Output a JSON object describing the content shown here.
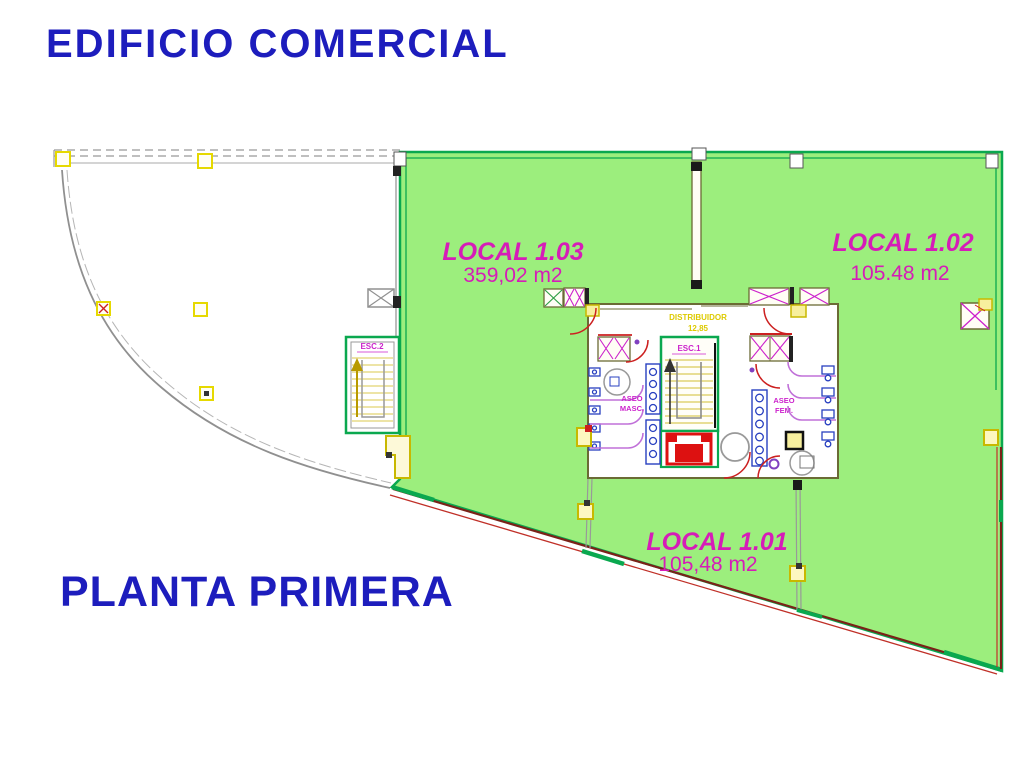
{
  "titles": {
    "building": "EDIFICIO COMERCIAL",
    "floor": "PLANTA PRIMERA"
  },
  "units": [
    {
      "name": "LOCAL 1.03",
      "area": "359,02 m2"
    },
    {
      "name": "LOCAL 1.02",
      "area": "105.48 m2"
    },
    {
      "name": "LOCAL 1.01",
      "area": "105,48 m2"
    }
  ],
  "core": {
    "stair1": "ESC.1",
    "stair2": "ESC.2",
    "men_restroom": [
      "ASEO",
      "MASC."
    ],
    "women_restroom": [
      "ASEO",
      "FEM."
    ],
    "corridor": [
      "DISTRIBUIDOR",
      "12,85"
    ]
  },
  "colors": {
    "title_blue": "#1d1dbd",
    "label_magenta": "#d61cb8",
    "floor_fill_green": "#9cee7d",
    "border_green": "#0aa84f",
    "facade_red": "#c03028",
    "cad_yellow": "#e6d900",
    "wall_olive": "#6b6b35"
  }
}
